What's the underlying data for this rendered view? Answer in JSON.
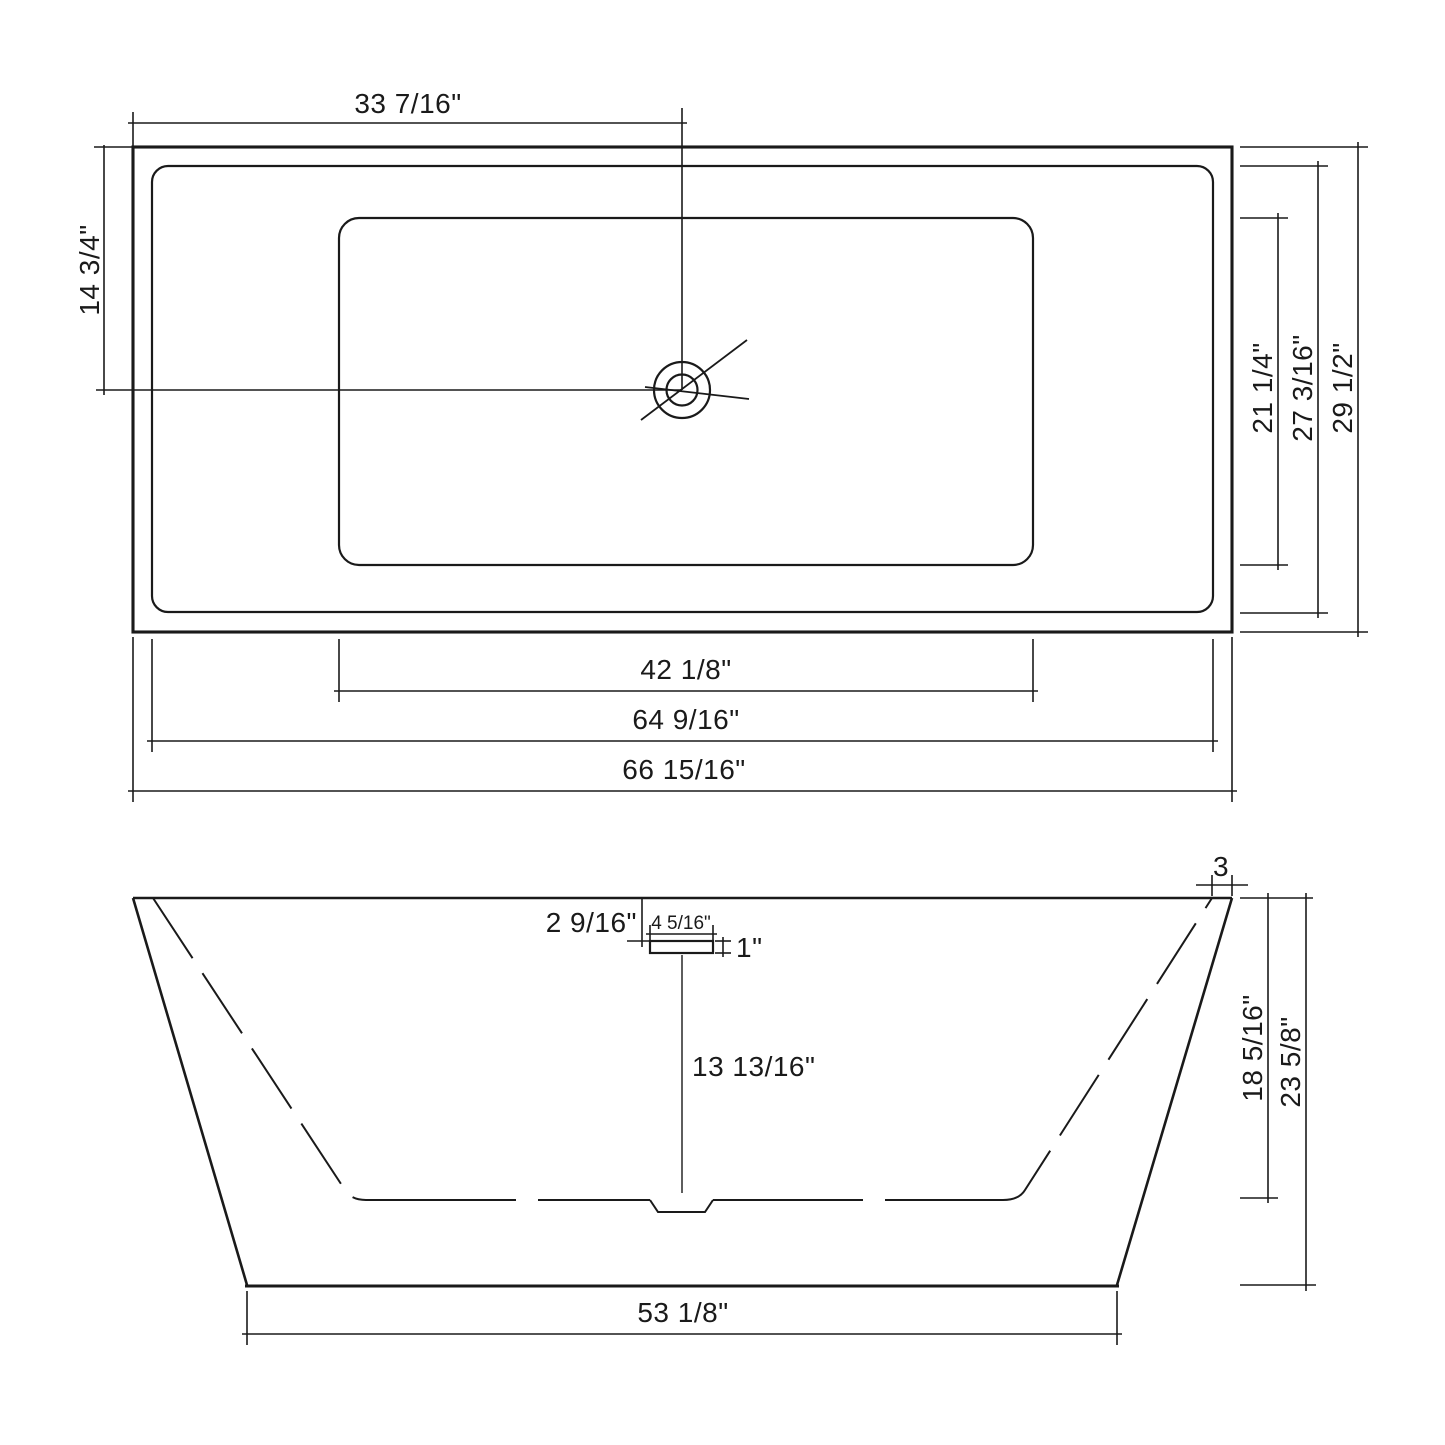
{
  "drawing": {
    "type": "technical-dimension-drawing",
    "subject": "rectangular freestanding bathtub, plan view and front elevation",
    "background_color": "#ffffff",
    "line_color": "#1a1a1a",
    "top_view": {
      "dims": {
        "drain_center_from_left_edge": "33 7/16\"",
        "drain_center_from_top_edge": "14 3/4\"",
        "basin_floor_length": "42 1/8\"",
        "inner_rim_length": "64 9/16\"",
        "overall_length": "66 15/16\"",
        "basin_floor_width": "21 1/4\"",
        "inner_rim_width": "27 3/16\"",
        "overall_width": "29 1/2\""
      }
    },
    "side_view": {
      "dims": {
        "rim_to_overflow": "2 9/16\"",
        "overflow_length": "4 5/16\"",
        "overflow_height": "1\"",
        "overflow_to_basin_floor": "13 13/16\"",
        "basin_inner_depth": "18 5/16\"",
        "overall_height": "23 5/8\"",
        "rim_wall_offset": "3",
        "base_length": "53 1/8\""
      }
    }
  }
}
